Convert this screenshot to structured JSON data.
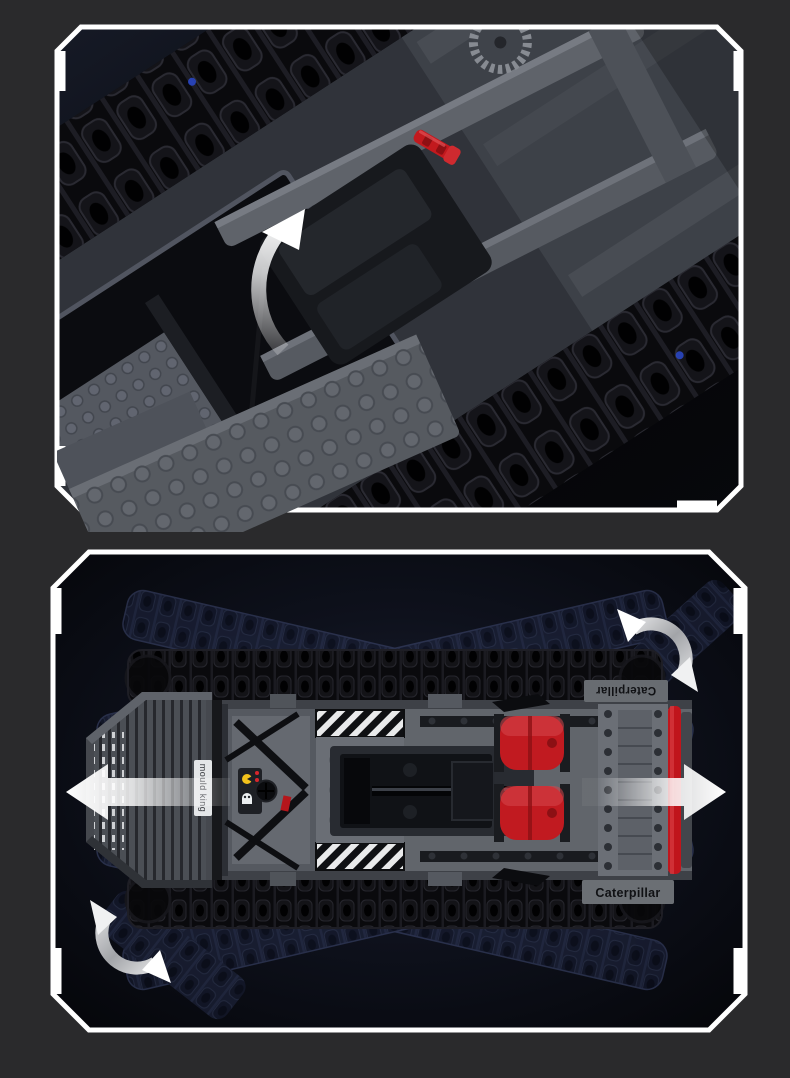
{
  "page": {
    "background_color": "#2a2a2c",
    "frame_color": "#ffffff"
  },
  "branding": {
    "track_label_top": "Caterpillar",
    "track_label_bottom": "Caterpillar",
    "blade_plate_label": "mould king"
  },
  "colors": {
    "body_gray": "#64686e",
    "body_dark_gray": "#3c4046",
    "track_black": "#0b0b0e",
    "accent_red": "#c3191f",
    "ghost_track_blue": "#2a3150",
    "annotation_white": "#ffffff",
    "panel_bg_dark": "#0a0c14"
  },
  "icons": {
    "top_panel": [
      "lift-open-curved-arrow",
      "red-axle-pin"
    ],
    "bottom_panel": [
      "move-left-arrow",
      "move-right-arrow",
      "rotate-curved-arrow-top-right",
      "rotate-curved-arrow-bottom-left"
    ]
  }
}
